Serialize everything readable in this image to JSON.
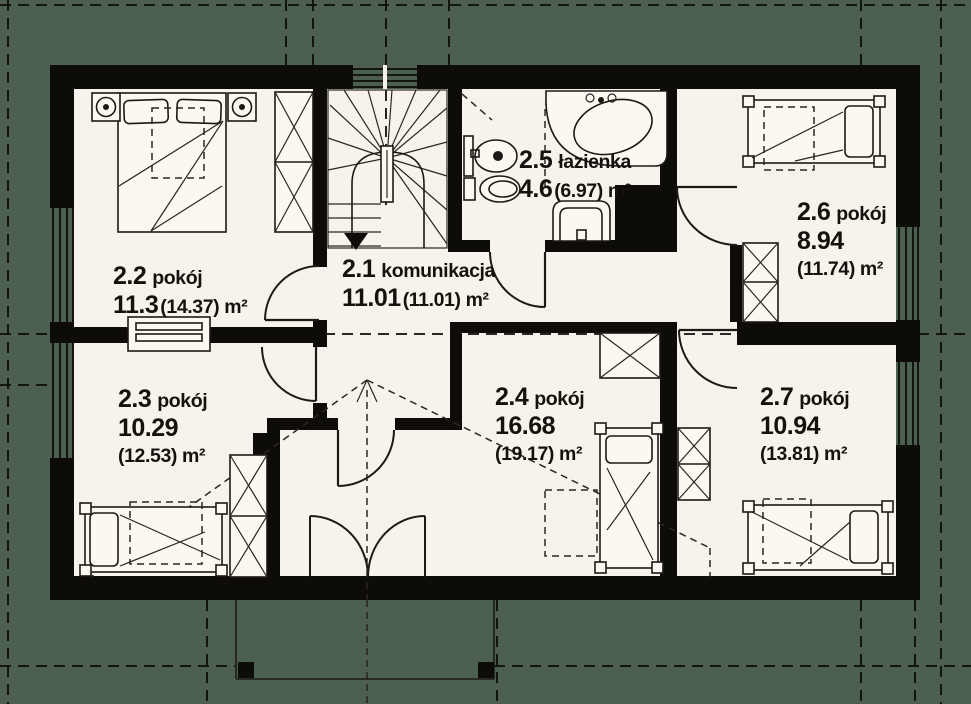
{
  "plan": {
    "title": "floor plan - attic storey",
    "background_color": "#4d5f4e",
    "floor_color": "#f7f3ec",
    "wall_color": "#0e0c09",
    "rooms": [
      {
        "number": "2.1",
        "name": "komunikacja",
        "area_line": "11.01",
        "area_total": "(11.01) m²"
      },
      {
        "number": "2.2",
        "name": "pokój",
        "area_line": "11.3",
        "area_total": "(14.37) m²"
      },
      {
        "number": "2.3",
        "name": "pokój",
        "area_line": "10.29",
        "area_total": "(12.53) m²"
      },
      {
        "number": "2.4",
        "name": "pokój",
        "area_line": "16.68",
        "area_total": "(19.17) m²"
      },
      {
        "number": "2.5",
        "name": "łazienka",
        "area_line": "4.6",
        "area_total": "(6.97) m²"
      },
      {
        "number": "2.6",
        "name": "pokój",
        "area_line": "8.94",
        "area_total": "(11.74) m²"
      },
      {
        "number": "2.7",
        "name": "pokój",
        "area_line": "10.94",
        "area_total": "(13.81) m²"
      }
    ],
    "fixtures": [
      "staircase",
      "corner-bathtub",
      "washbasin",
      "toilet",
      "sink",
      "double-bed",
      "single-bed",
      "wardrobe",
      "nightstand-lamp",
      "radiator",
      "balcony",
      "french-balcony-door",
      "roof-slope-lines"
    ]
  }
}
